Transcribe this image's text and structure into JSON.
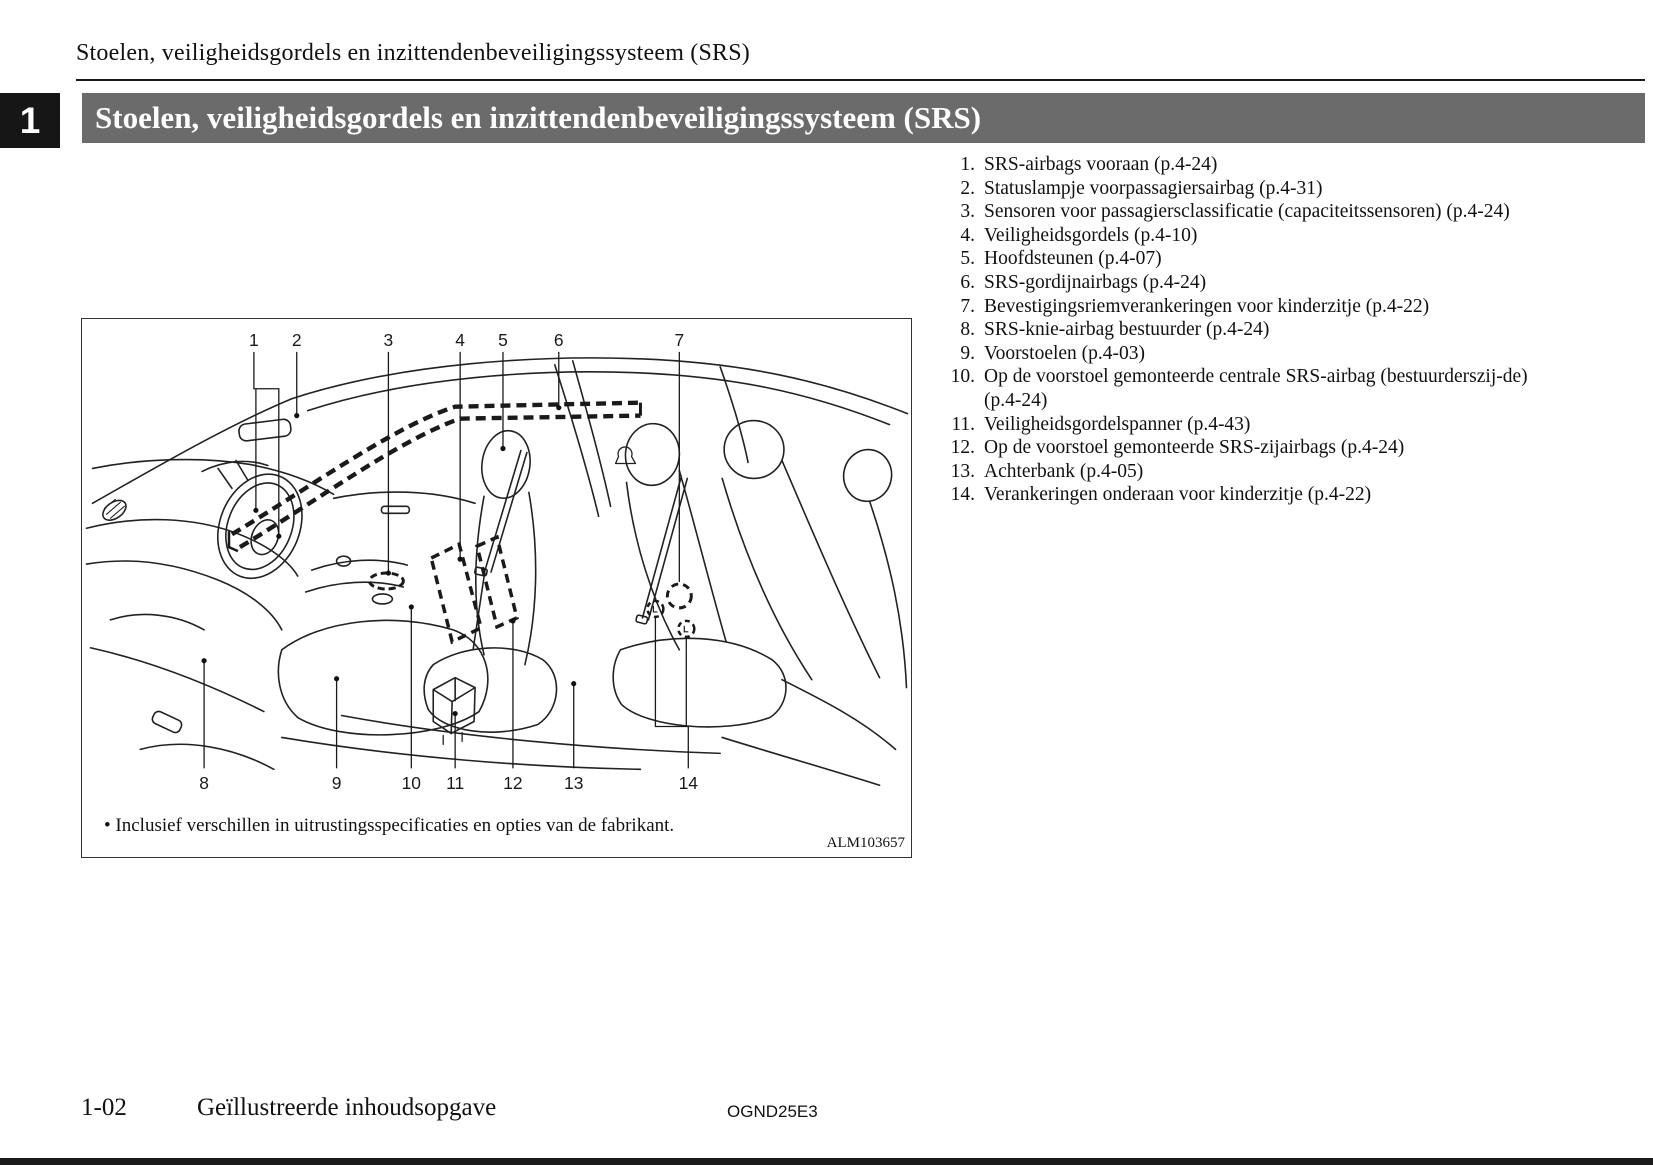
{
  "page": {
    "header": "Stoelen, veiligheidsgordels en inzittendenbeveiligingssysteem (SRS)",
    "chapter_tab": "1",
    "section_title": "Stoelen, veiligheidsgordels en inzittendenbeveiligingssysteem (SRS)",
    "footer": {
      "page_number": "1-02",
      "title": "Geïllustreerde inhoudsopgave",
      "doc_code": "OGND25E3"
    }
  },
  "figure": {
    "caption_bullet": "•",
    "caption_text": "Inclusief verschillen in uitrustingsspecificaties en opties van de fabrikant.",
    "figure_code": "ALM103657",
    "top_labels": [
      "1",
      "2",
      "3",
      "4",
      "5",
      "6",
      "7"
    ],
    "bottom_labels": [
      "8",
      "9",
      "10",
      "11",
      "12",
      "13",
      "14"
    ]
  },
  "legend": {
    "items": [
      {
        "num": "1.",
        "text": "SRS-airbags vooraan (p.4-24)"
      },
      {
        "num": "2.",
        "text": "Statuslampje voorpassagiersairbag (p.4-31)"
      },
      {
        "num": "3.",
        "text": "Sensoren voor passagiersclassificatie (capaciteitssensoren) (p.4-24)"
      },
      {
        "num": "4.",
        "text": "Veiligheidsgordels (p.4-10)"
      },
      {
        "num": "5.",
        "text": "Hoofdsteunen (p.4-07)"
      },
      {
        "num": "6.",
        "text": "SRS-gordijnairbags (p.4-24)"
      },
      {
        "num": "7.",
        "text": "Bevestigingsriemverankeringen voor kinderzitje (p.4-22)"
      },
      {
        "num": "8.",
        "text": "SRS-knie-airbag bestuurder (p.4-24)"
      },
      {
        "num": "9.",
        "text": "Voorstoelen (p.4-03)"
      },
      {
        "num": "10.",
        "text": "Op de voorstoel gemonteerde centrale SRS-airbag (bestuurderszij-de) (p.4-24)"
      },
      {
        "num": "11.",
        "text": "Veiligheidsgordelspanner (p.4-43)"
      },
      {
        "num": "12.",
        "text": "Op de voorstoel gemonteerde SRS-zijairbags (p.4-24)"
      },
      {
        "num": "13.",
        "text": "Achterbank (p.4-05)"
      },
      {
        "num": "14.",
        "text": "Verankeringen onderaan voor kinderzitje (p.4-22)"
      }
    ]
  }
}
